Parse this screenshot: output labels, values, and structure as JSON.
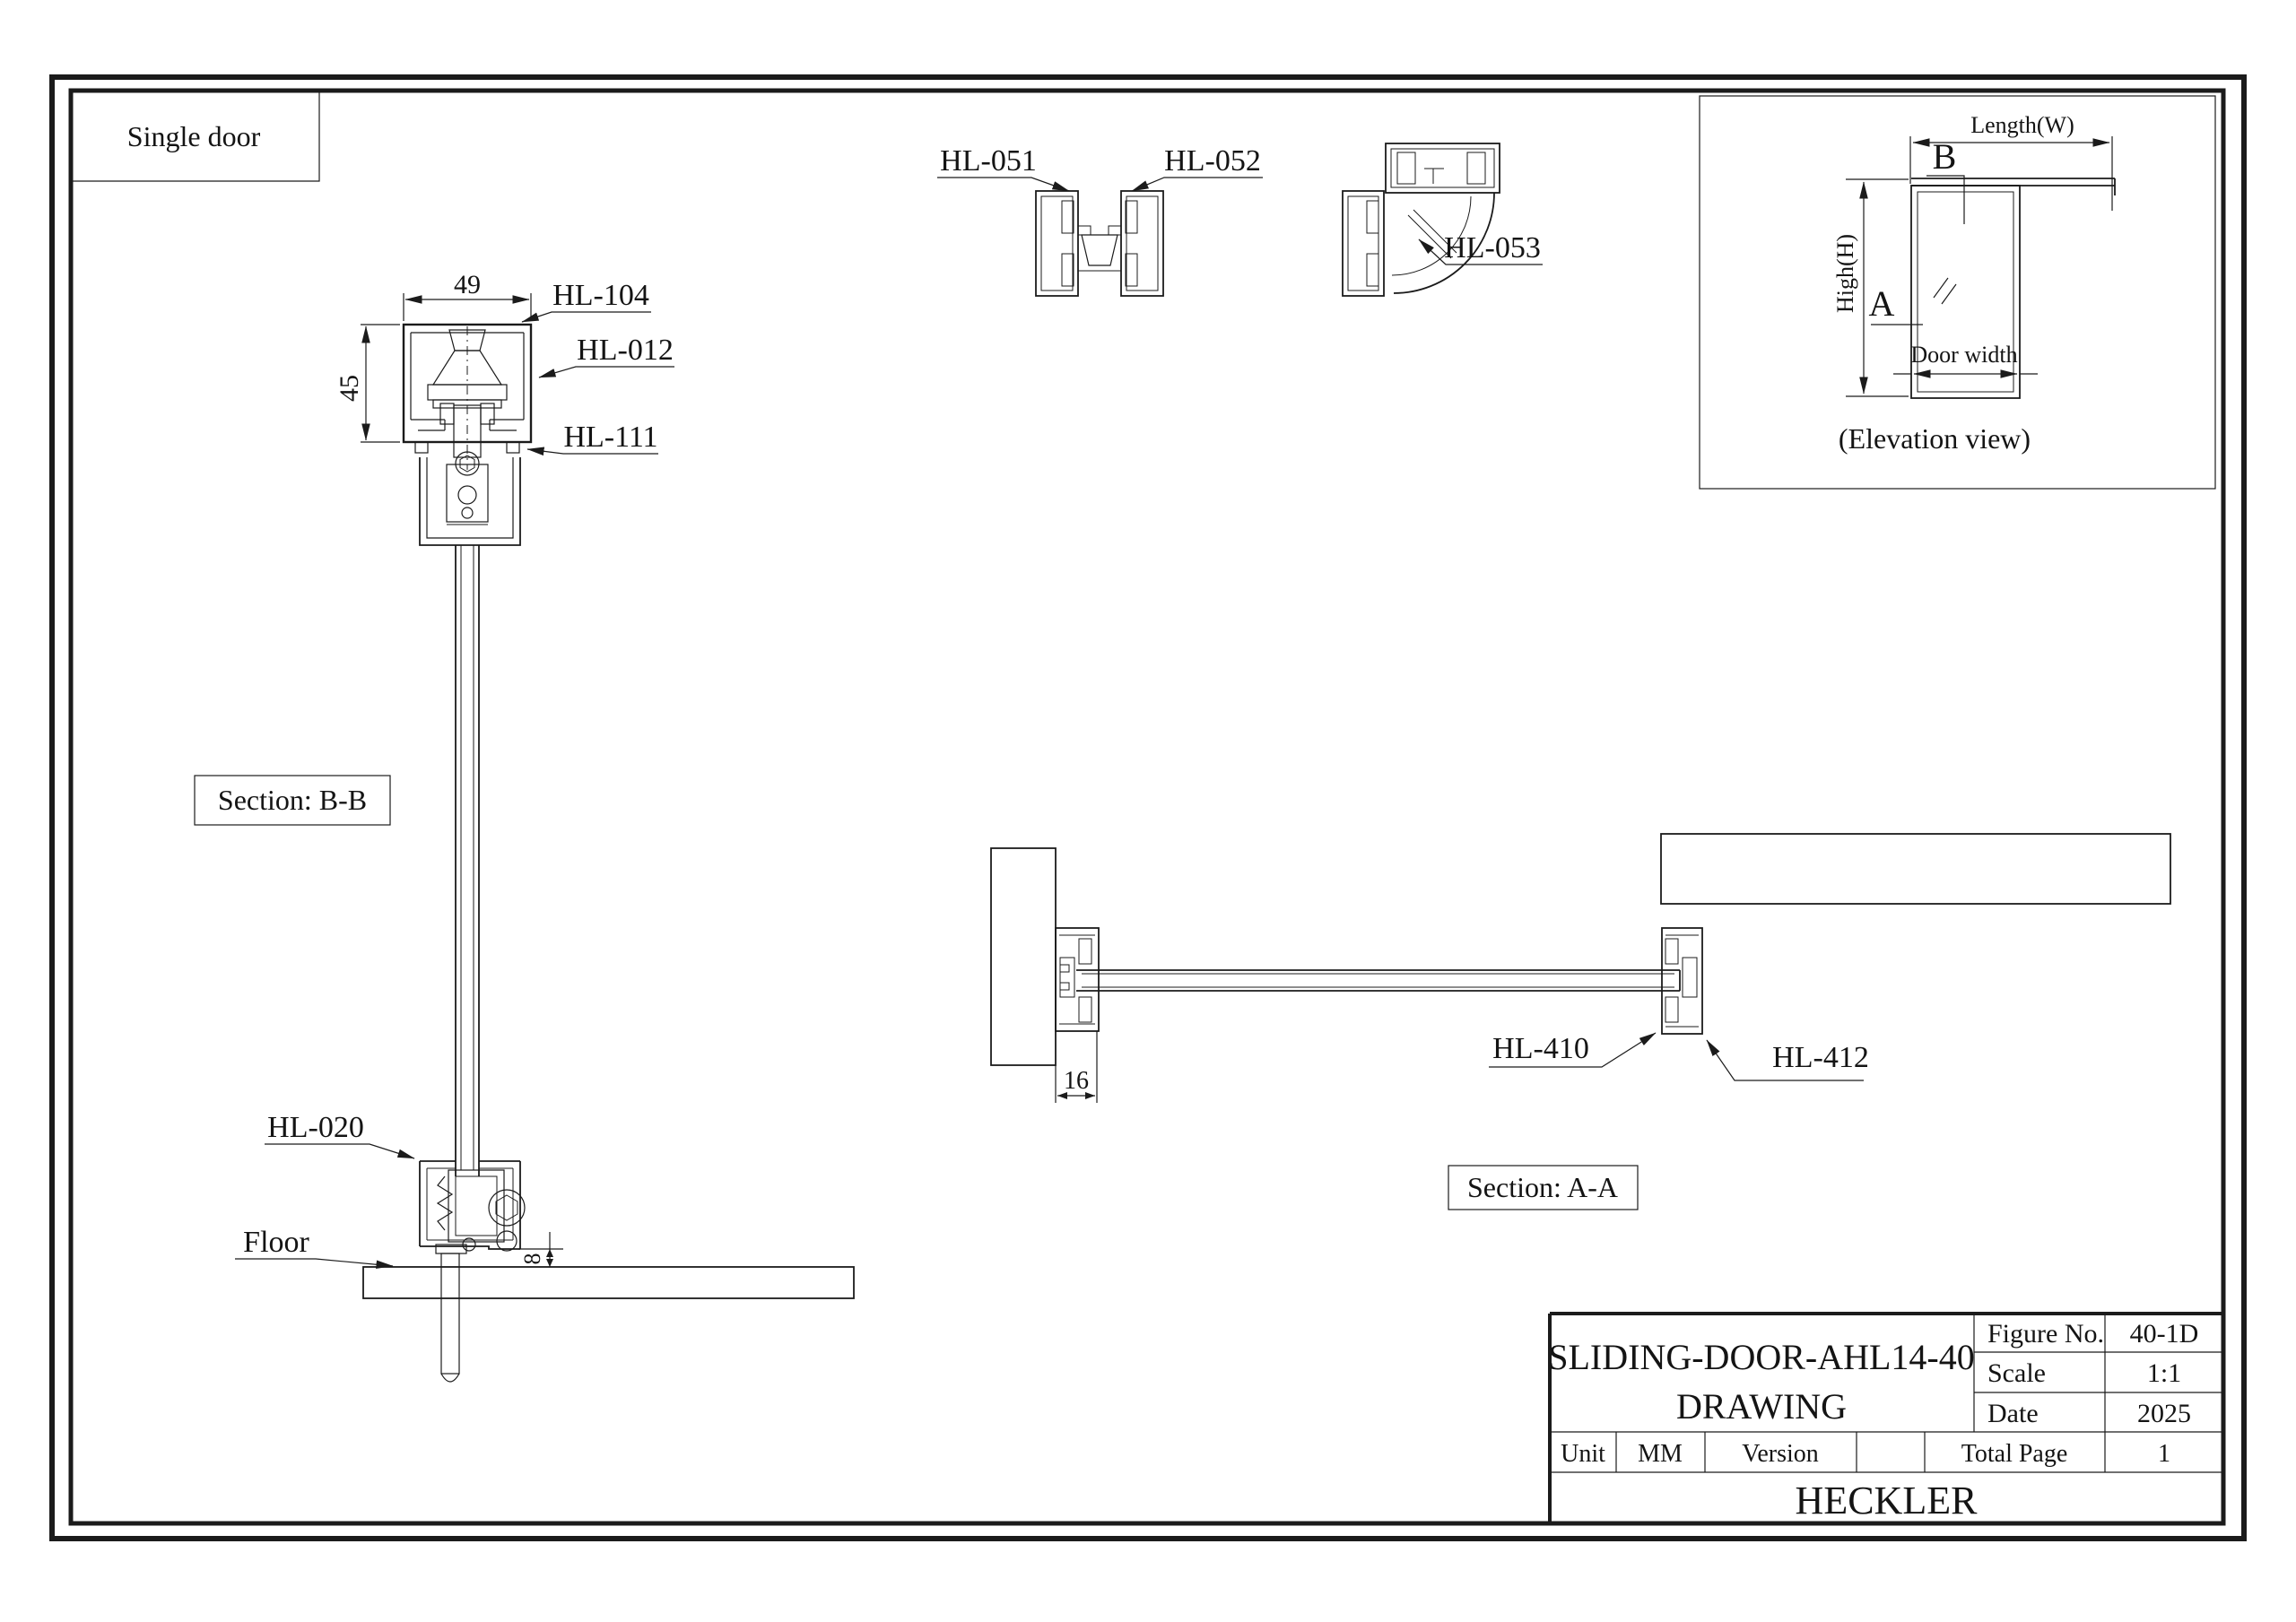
{
  "page": {
    "corner_label": "Single door",
    "company": "HECKLER"
  },
  "title_block": {
    "title_line1": "SLIDING-DOOR-AHL14-40",
    "title_line2": "DRAWING",
    "figure_no_label": "Figure No.",
    "figure_no": "40-1D",
    "scale_label": "Scale",
    "scale": "1:1",
    "date_label": "Date",
    "date": "2025",
    "unit_label": "Unit",
    "unit": "MM",
    "version_label": "Version",
    "version": "",
    "total_page_label": "Total Page",
    "total_page": "1"
  },
  "section_bb": {
    "caption": "Section: B-B",
    "dim_track_width": "49",
    "dim_track_height": "45",
    "dim_floor_gap": "8",
    "label_track": "HL-104",
    "label_roller": "HL-012",
    "label_hanger": "HL-111",
    "label_floor_guide": "HL-020",
    "label_floor": "Floor"
  },
  "profiles": {
    "interlock_left": "HL-051",
    "interlock_right": "HL-052",
    "corner": "HL-053"
  },
  "elevation": {
    "caption": "(Elevation view)",
    "dim_length": "Length(W)",
    "dim_height": "High(H)",
    "dim_door_width": "Door width",
    "marker_a": "A",
    "marker_b": "B"
  },
  "section_aa": {
    "caption": "Section: A-A",
    "dim_jamb_width": "16",
    "label_end_profile": "HL-410",
    "label_wall_profile": "HL-412"
  }
}
